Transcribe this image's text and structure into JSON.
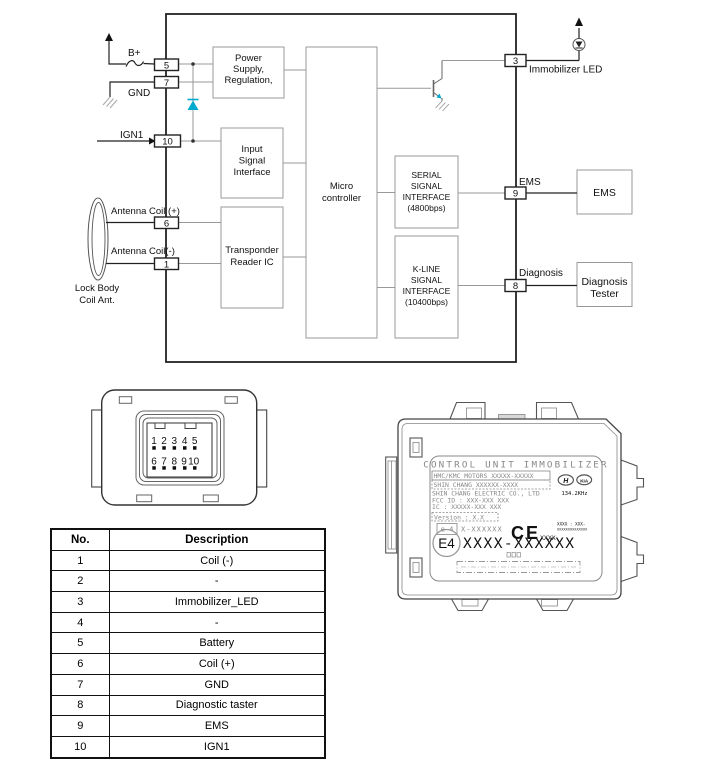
{
  "colors": {
    "cyan": "#00a9ce",
    "line_dark": "#222222",
    "line_gray": "#999999"
  },
  "circuit": {
    "labels": {
      "bplus": "B+",
      "gnd": "GND",
      "ign1": "IGN1",
      "ant_plus": "Antenna Coil (+)",
      "ant_minus": "Antenna Coil(-)",
      "lock_body_1": "Lock Body",
      "lock_body_2": "Coil Ant.",
      "immobilizer_led": "Immobilizer LED",
      "ems": "EMS",
      "diagnosis": "Diagnosis"
    },
    "pins": {
      "p5": "5",
      "p7": "7",
      "p10": "10",
      "p6": "6",
      "p1": "1",
      "p3": "3",
      "p9": "9",
      "p8": "8"
    },
    "blocks": {
      "power": {
        "l1": "Power",
        "l2": "Supply,",
        "l3": "Regulation,"
      },
      "input": {
        "l1": "Input",
        "l2": "Signal",
        "l3": "Interface"
      },
      "transponder": {
        "l1": "Transponder",
        "l2": "Reader IC"
      },
      "micro": {
        "l1": "Micro",
        "l2": "controller"
      },
      "serial": {
        "l1": "SERIAL",
        "l2": "SIGNAL",
        "l3": "INTERFACE",
        "l4": "(4800bps)"
      },
      "kline": {
        "l1": "K-LINE",
        "l2": "SIGNAL",
        "l3": "INTERFACE",
        "l4": "(10400bps)"
      },
      "ems": {
        "l1": "EMS"
      },
      "tester": {
        "l1": "Diagnosis",
        "l2": "Tester"
      }
    }
  },
  "connector": {
    "row1": [
      "1",
      "2",
      "3",
      "4",
      "5"
    ],
    "row2": [
      "6",
      "7",
      "8",
      "9",
      "10"
    ]
  },
  "device": {
    "title": "CONTROL UNIT IMMOBILIZER",
    "line1": "HMC/KMC MOTORS XXXXX-XXXXX",
    "line2": "SHIN CHANG XXXXXX-XXXX",
    "line3": "SHIN CHANG ELECTRIC CO., LTD",
    "line4": "FCC ID : XXX-XXX XXX",
    "line5": "IC : XXXXX-XXX XXX",
    "version": "Version : X.X",
    "e4_small": "e 4",
    "e4_code": "X-XXXXXX",
    "ce": "CE",
    "ce_xxxx": "XXXX",
    "tiny1": "XXXX : XXX-",
    "tiny2": "XXXXXXXXXXXXXX",
    "freq": "134.2KHz",
    "hyundai": "H",
    "kia": "KIA",
    "e4_big": "E4",
    "big_code": "XXXX-XXXXXX"
  },
  "table": {
    "headers": [
      "No.",
      "Description"
    ],
    "rows": [
      [
        "1",
        "Coil (-)"
      ],
      [
        "2",
        "-"
      ],
      [
        "3",
        "Immobilizer_LED"
      ],
      [
        "4",
        "-"
      ],
      [
        "5",
        "Battery"
      ],
      [
        "6",
        "Coil (+)"
      ],
      [
        "7",
        "GND"
      ],
      [
        "8",
        "Diagnostic taster"
      ],
      [
        "9",
        "EMS"
      ],
      [
        "10",
        "IGN1"
      ]
    ]
  }
}
